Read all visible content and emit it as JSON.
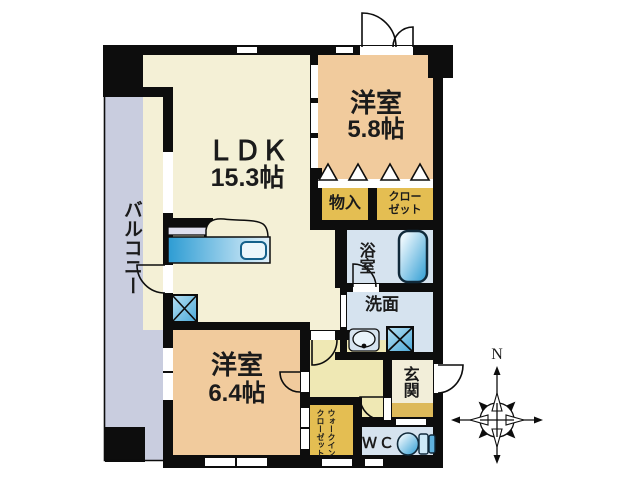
{
  "plan": {
    "rooms": {
      "ldk": {
        "name": "ＬＤＫ",
        "size": "15.3帖"
      },
      "bedroom_upper": {
        "name": "洋室",
        "size": "5.8帖"
      },
      "bedroom_lower": {
        "name": "洋室",
        "size": "6.4帖"
      },
      "balcony": {
        "name": "バルコニー"
      },
      "storage": {
        "name": "物入"
      },
      "closet": {
        "name": "クローゼット",
        "lines": [
          "クロー",
          "ゼット"
        ]
      },
      "bathroom": {
        "name": "浴室"
      },
      "washroom": {
        "name": "洗面"
      },
      "entrance": {
        "name": "玄関"
      },
      "toilet_room": {
        "name": "ＷＣ"
      },
      "walk_in_closet": {
        "name": "ウォークインクローゼット",
        "lines": [
          "ウォークイン",
          "クローゼット"
        ]
      }
    },
    "compass": {
      "north_label": "N"
    },
    "fixtures": [
      "kitchen-sink-counter",
      "bathtub",
      "washbasin",
      "washing-machine-space",
      "toilet",
      "pipe-space"
    ],
    "colors": {
      "wall": "#0d0d0d",
      "ldk_cream": "#f4f0d6",
      "bedroom_peach": "#f1cb9d",
      "closet_yellow": "#e4be52",
      "water_blue": "#d6e3ef",
      "balcony_lavender": "#c9cddf",
      "hallway_yellow": "#efe8b4",
      "entrance_floor": "#f2eed9",
      "entrance_step": "#ddb95a",
      "fixture_blue": "#2d9cd3"
    }
  }
}
